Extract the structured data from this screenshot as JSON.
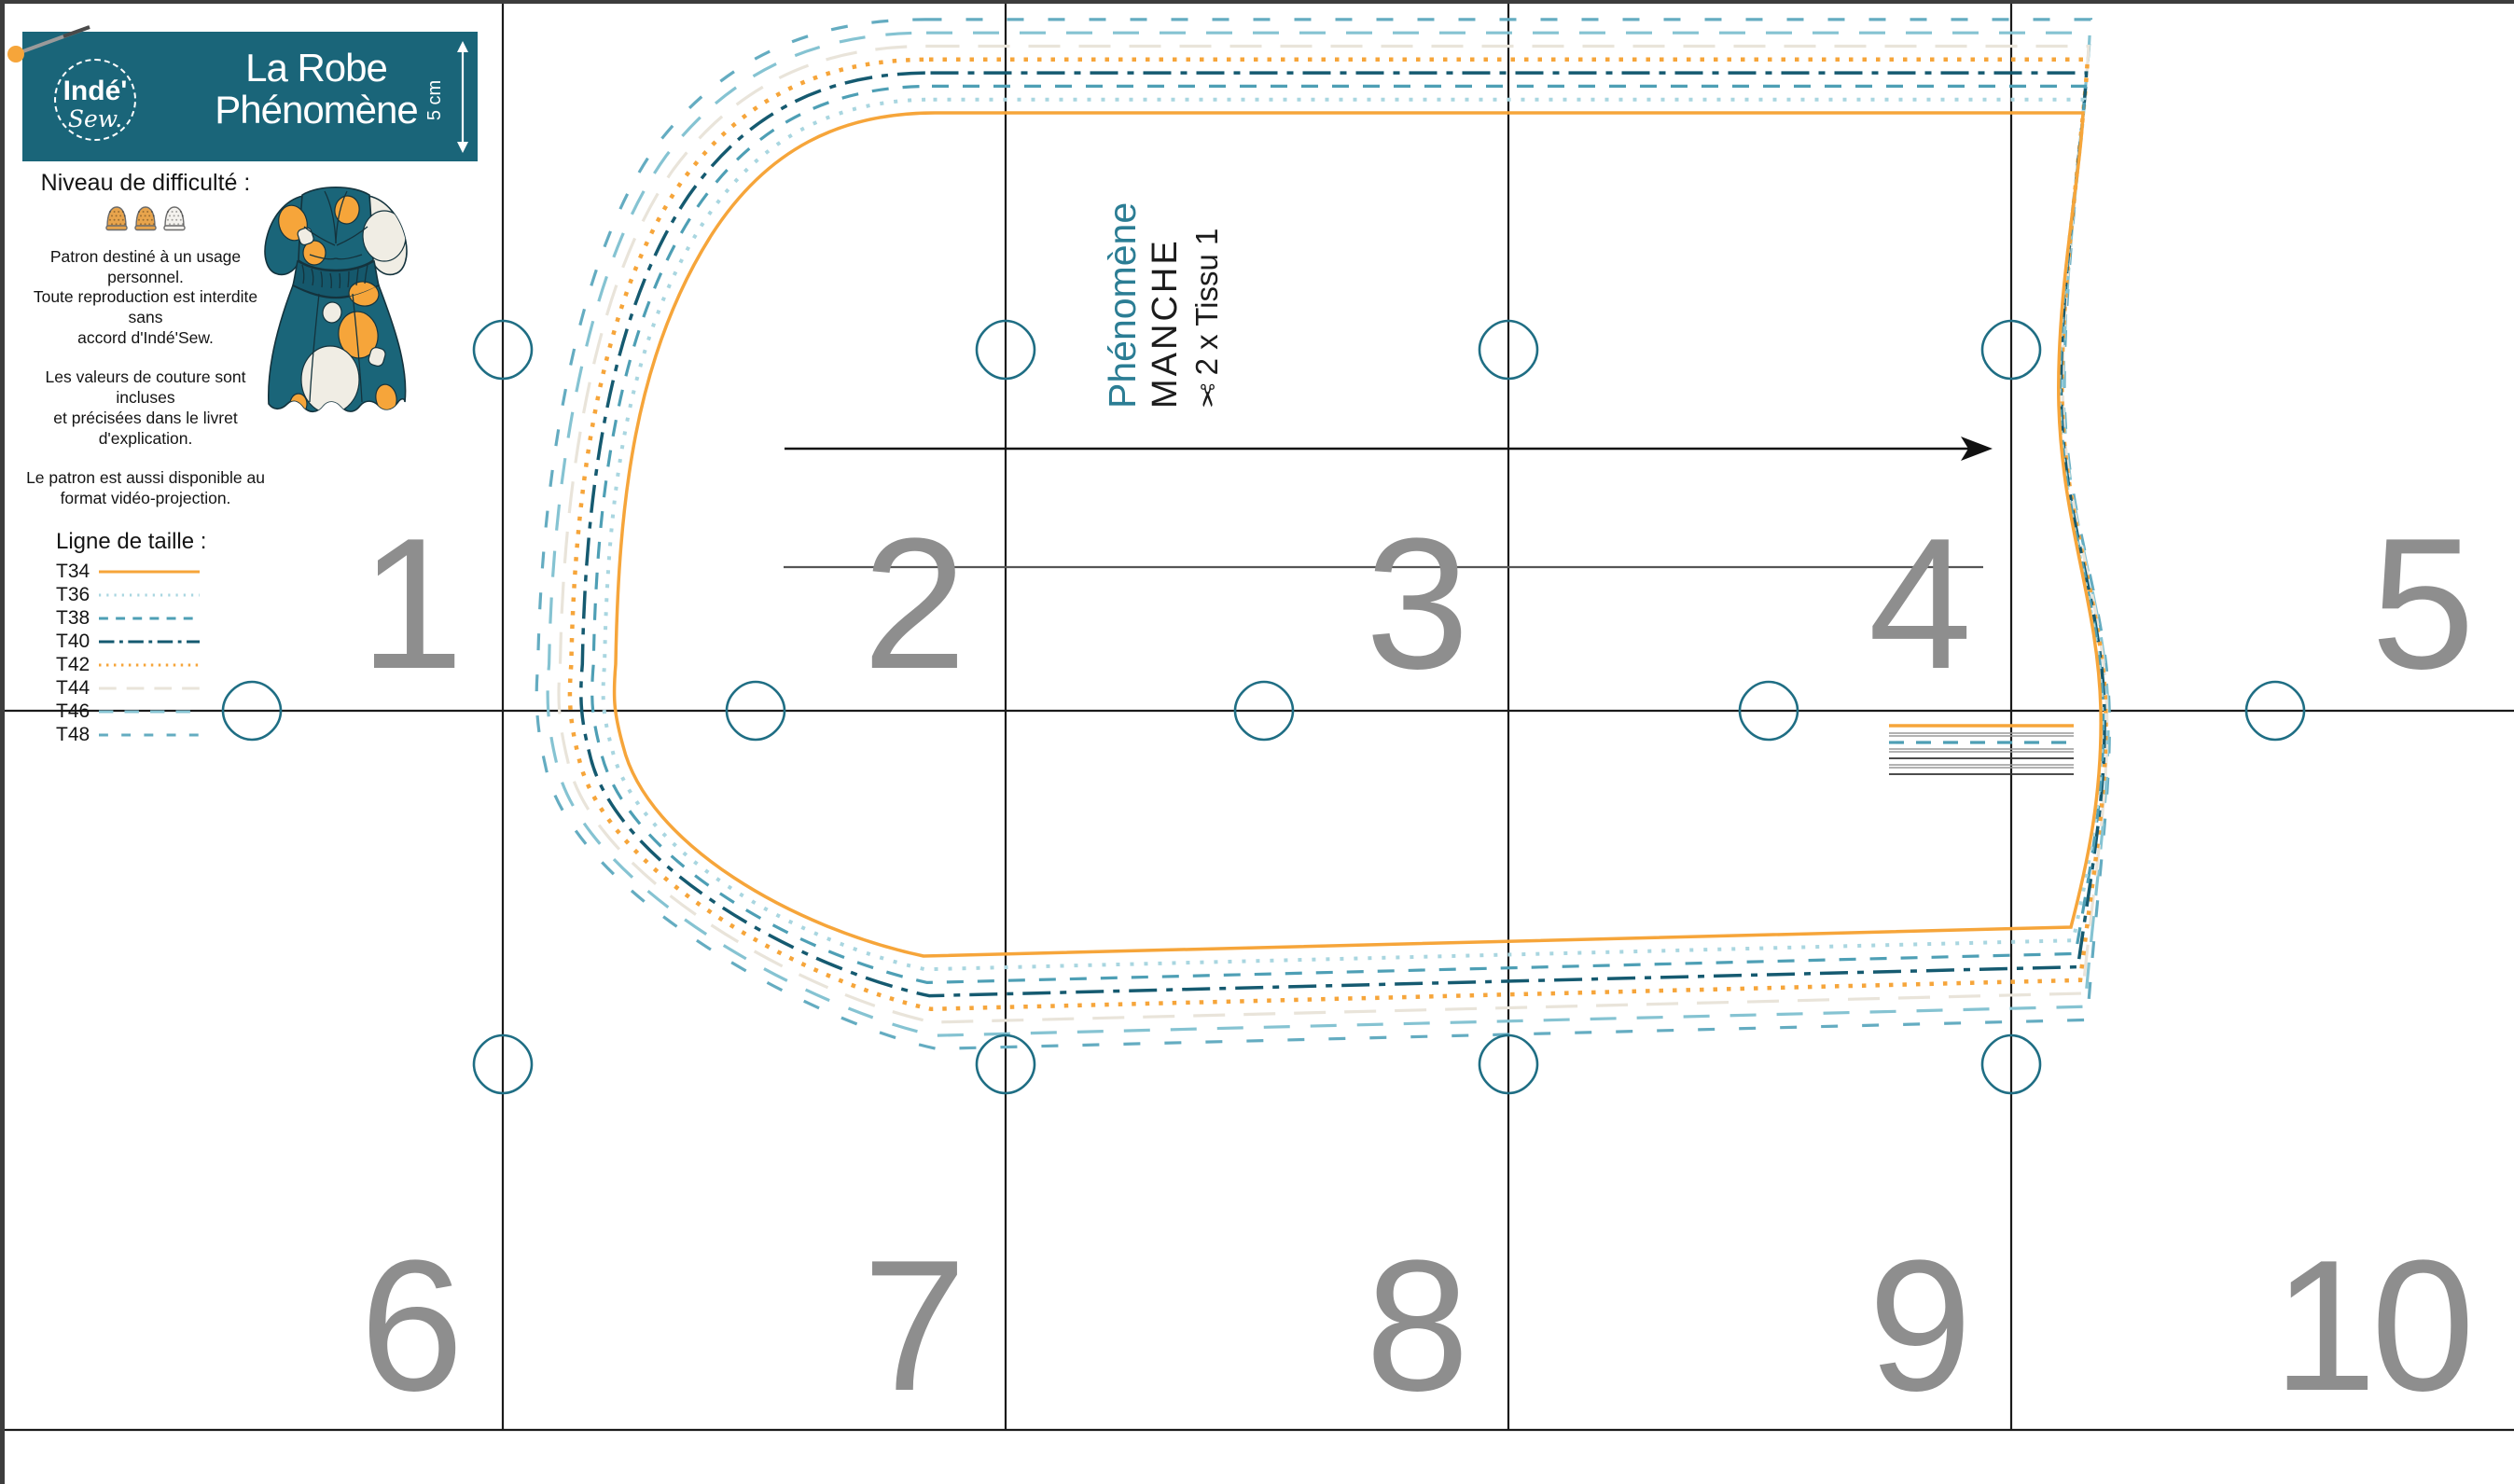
{
  "brand": {
    "top": "Indé'",
    "bottom": "Sew."
  },
  "header": {
    "title_line1": "La Robe",
    "title_line2": "Phénomène",
    "scale_label": "5 cm"
  },
  "info": {
    "difficulty_label": "Niveau de difficulté :",
    "difficulty": {
      "filled": 2,
      "total": 3
    },
    "paragraphs": [
      "Patron destiné à un usage personnel.\nToute reproduction est interdite sans\naccord d'Indé'Sew.",
      "Les valeurs de couture sont incluses\net précisées dans le livret d'explication.",
      "Le patron est aussi disponible au\nformat vidéo-projection."
    ],
    "legend_title": "Ligne de taille :",
    "sizes": [
      {
        "label": "T34",
        "color": "#F6A53A",
        "dash": ""
      },
      {
        "label": "T36",
        "color": "#A9D6E0",
        "dash": "4 11"
      },
      {
        "label": "T38",
        "color": "#4E9FB5",
        "dash": "18 15"
      },
      {
        "label": "T40",
        "color": "#155A70",
        "dash": "30 10 7 10"
      },
      {
        "label": "T42",
        "color": "#F6A53A",
        "dash": "4.5 10"
      },
      {
        "label": "T44",
        "color": "#E9E4DA",
        "dash": "34 20"
      },
      {
        "label": "T46",
        "color": "#85C3D2",
        "dash": "28 22"
      },
      {
        "label": "T48",
        "color": "#64ACC1",
        "dash": "18 26"
      }
    ]
  },
  "piece": {
    "collection": "Phénomène",
    "name": "MANCHE",
    "scissors": "✂",
    "cut": "2 x Tissu 1"
  },
  "grid": {
    "numbers": [
      "1",
      "2",
      "3",
      "4",
      "5",
      "6",
      "7",
      "8",
      "9",
      "10"
    ]
  },
  "colors": {
    "teal_band": "#1A6579",
    "teal_mark": "#1F6E84",
    "orange": "#F6A53A",
    "number_gray": "#8E8E8E",
    "grid_line": "#1A1A1A"
  }
}
